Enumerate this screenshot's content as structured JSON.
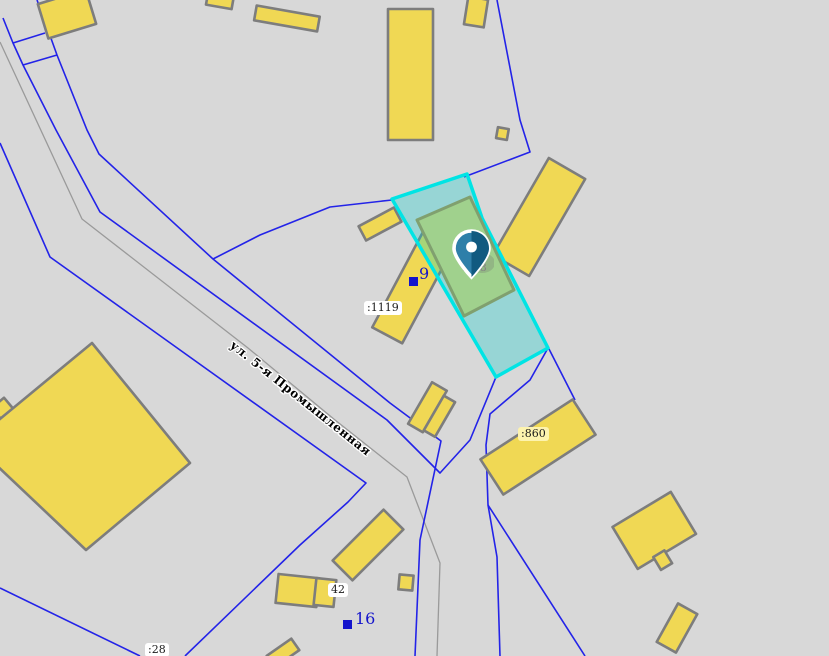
{
  "map": {
    "street_name": "ул. 5-я Промышленная",
    "selected_parcel_label": ":108",
    "parcel_labels": {
      "p1119": ":1119",
      "p860": ":860",
      "p28": ":28"
    },
    "address_numbers": {
      "n9": "9",
      "n16": "16",
      "n42": "42"
    },
    "colors": {
      "background": "#d8d8d8",
      "parcel_boundary_blue": "#2323e8",
      "road_line_gray": "#9a9a9a",
      "building_fill": "#f0d854",
      "building_stroke": "#7d7d7d",
      "highlight_parcel_stroke": "#00e4e4",
      "highlight_parcel_fill": "rgba(0,205,205,0.30)",
      "selected_building_fill": "#a0d18d",
      "selected_building_stroke": "#80a06f",
      "marker_blue_light": "#2e7fa9",
      "marker_blue_dark": "#115a80",
      "address_label_blue": "#1313cb",
      "selected_label_gray": "#8b8b8b"
    }
  }
}
